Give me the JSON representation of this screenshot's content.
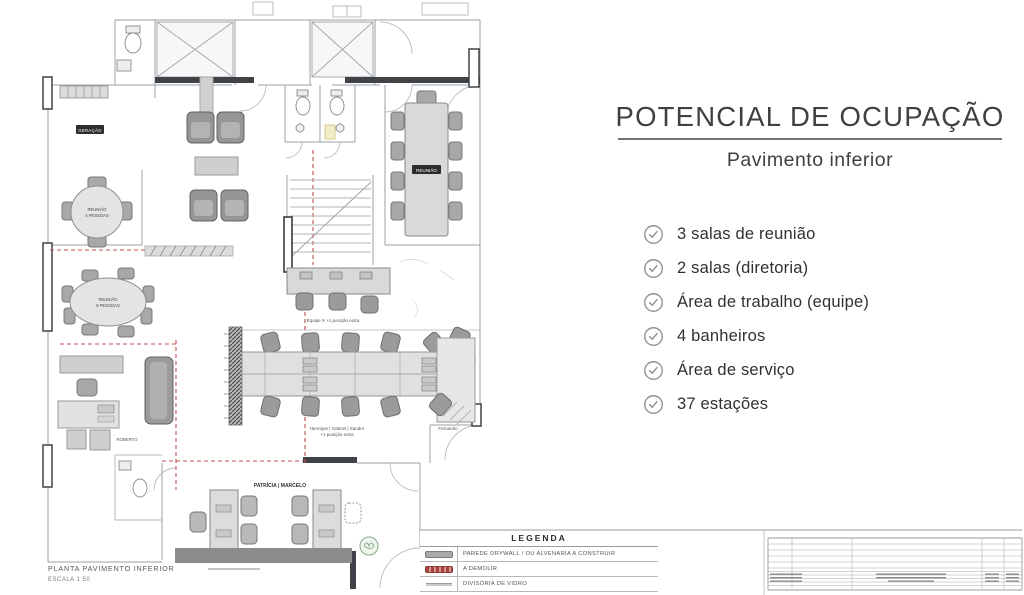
{
  "panel": {
    "title": "POTENCIAL DE OCUPAÇÃO",
    "subtitle": "Pavimento inferior",
    "items": [
      {
        "label": "3 salas de reunião"
      },
      {
        "label": "2 salas (diretoria)"
      },
      {
        "label": "Área de trabalho (equipe)"
      },
      {
        "label": "4 banheiros"
      },
      {
        "label": "Área de serviço"
      },
      {
        "label": "37 estações"
      }
    ],
    "check_color": "#8d9296"
  },
  "plan": {
    "caption_title": "PLANTA PAVIMENTO INFERIOR",
    "caption_scale": "ESCALA 1:50",
    "labels": {
      "generator_room": "GERAÇÃO",
      "meeting4_line1": "REUNIÃO",
      "meeting4_line2": "4 PESSOAS",
      "meeting8_line1": "REUNIÃO",
      "meeting8_line2": "8 PESSOAS",
      "meeting_table": "REUNIÃO",
      "office": "ROBERTO",
      "team_note": "Equipe X +1 posição extra",
      "desks_note_line1": "Henrique | Gabriel | Sandro",
      "desks_note_line2": "+1 posição extra",
      "desk_owner": "Fernando",
      "retail_room": "PATRÍCIA | MARCELO"
    },
    "colors": {
      "wall": "#9aa0a5",
      "furniture": "#d9d9d9",
      "chair": "#9b9b9b",
      "demolish": "#c0504d",
      "plant": "#85aa85"
    }
  },
  "legend": {
    "title": "LEGENDA",
    "rows": [
      {
        "label": "PAREDE DRYWALL / OU ALVENARIA A CONSTRUIR"
      },
      {
        "label": "A DEMOLIR"
      },
      {
        "label": "DIVISÓRIA DE VIDRO"
      }
    ]
  }
}
